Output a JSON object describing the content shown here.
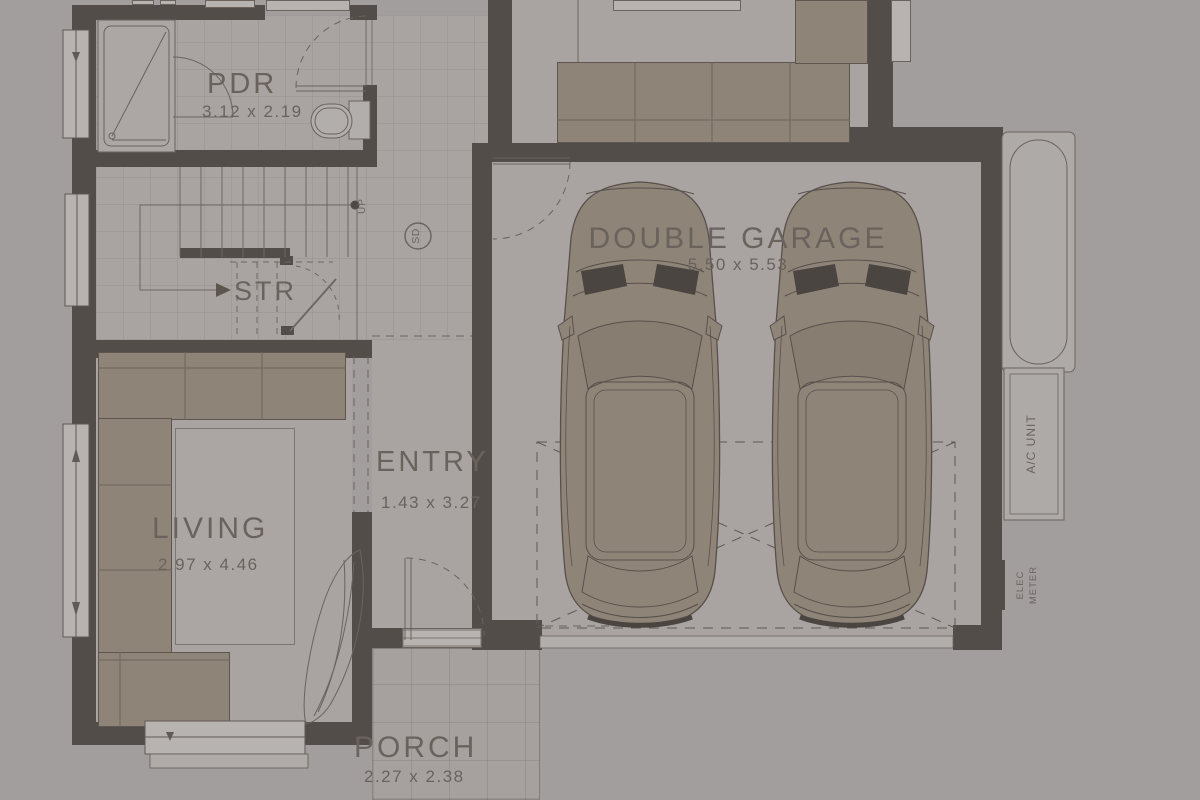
{
  "rooms": {
    "pdr": {
      "label": "PDR",
      "dims": "3.12 x 2.19"
    },
    "stairs": {
      "label": "STR",
      "up": "UP"
    },
    "living": {
      "label": "LIVING",
      "dims": "2.97 x 4.46"
    },
    "entry": {
      "label": "ENTRY",
      "dims": "1.43 x 3.27"
    },
    "garage": {
      "label": "DOUBLE GARAGE",
      "dims": "5.50 x 5.53"
    },
    "porch": {
      "label": "PORCH",
      "dims": "2.27 x 2.38"
    }
  },
  "annotations": {
    "smoke_detector": "SD",
    "ac_unit": "A/C UNIT",
    "elec": "ELEC",
    "meter": "METER"
  },
  "colors": {
    "background": "#a39e9e",
    "floor": "#a9a4a2",
    "wall": "#534d4a",
    "furniture": "#8f8478",
    "window": "#b7b3b1",
    "text": "#6a635d",
    "line": "#6a635d",
    "dark_detail": "#4b4541"
  }
}
